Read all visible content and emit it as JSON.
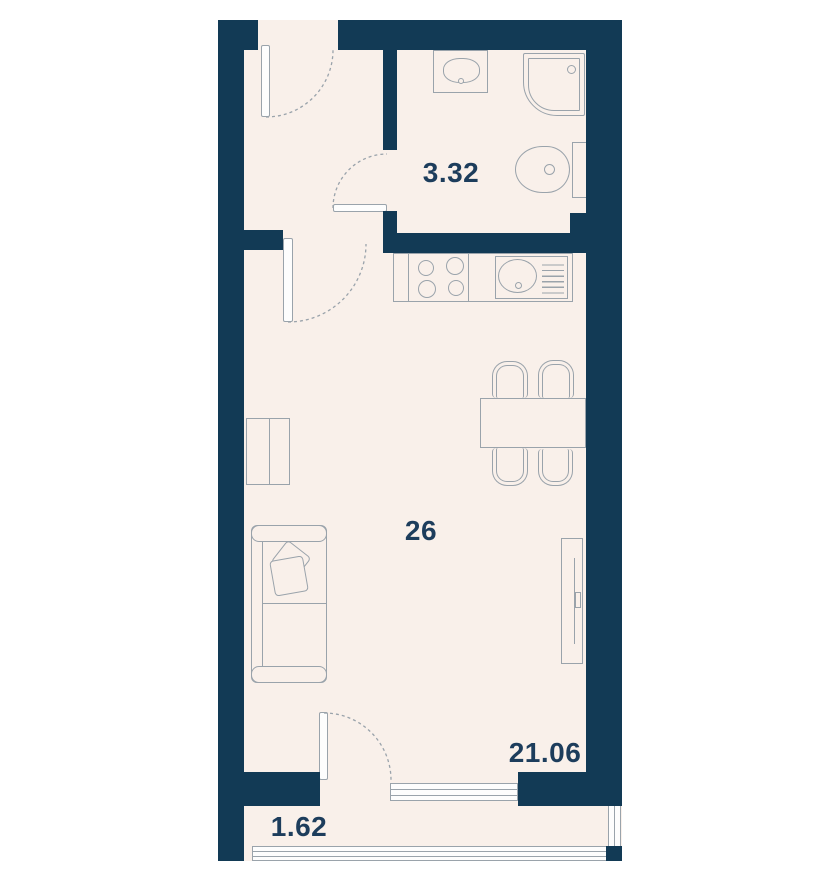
{
  "plan": {
    "unit_number": "26",
    "areas": {
      "bathroom": "3.32",
      "living_room": "21.06",
      "balcony": "1.62"
    }
  },
  "colors": {
    "wall": "#123a55",
    "floor": "#f9f0ea",
    "outline": "#9aa3ab",
    "label_text": "#1d3d5c",
    "page_background": "#ffffff"
  },
  "furniture_icons": [
    "washbasin-icon",
    "shower-icon",
    "toilet-icon",
    "stove-icon",
    "kitchen-sink-icon",
    "dining-table-icon",
    "chair-icon",
    "sofa-icon",
    "pillow-icon",
    "wardrobe-icon",
    "radiator-icon",
    "door-icon",
    "window-icon",
    "balcony-railing-icon"
  ]
}
